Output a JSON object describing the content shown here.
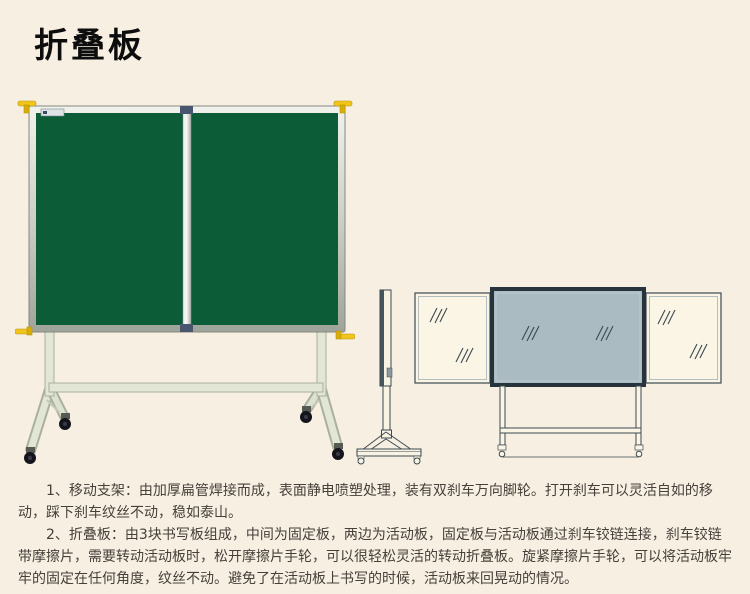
{
  "page": {
    "title": "折叠板"
  },
  "description": {
    "paragraphs": [
      "1、移动支架：由加厚扁管焊接而成，表面静电喷塑处理，装有双刹车万向脚轮。打开刹车可以灵活自如的移动，踩下刹车纹丝不动，稳如泰山。",
      "2、折叠板：由3块书写板组成，中间为固定板，两边为活动板，固定板与活动板通过刹车铰链连接，刹车铰链带摩擦片，需要转动活动板时，松开摩擦片手轮，可以很轻松灵活的转动折叠板。旋紧摩擦片手轮，可以将活动板牢牢的固定在任何角度，纹丝不动。避免了在活动板上书写的时候，活动板来回晃动的情况。"
    ]
  },
  "colors": {
    "background": "#f7efe1",
    "board_green": "#0b5c37",
    "knob_yellow": "#f2c51c",
    "diagram_line": "#3c4a52",
    "diagram_center_panel": "#aabbc1",
    "stand_metal": "#e2e6d4"
  }
}
